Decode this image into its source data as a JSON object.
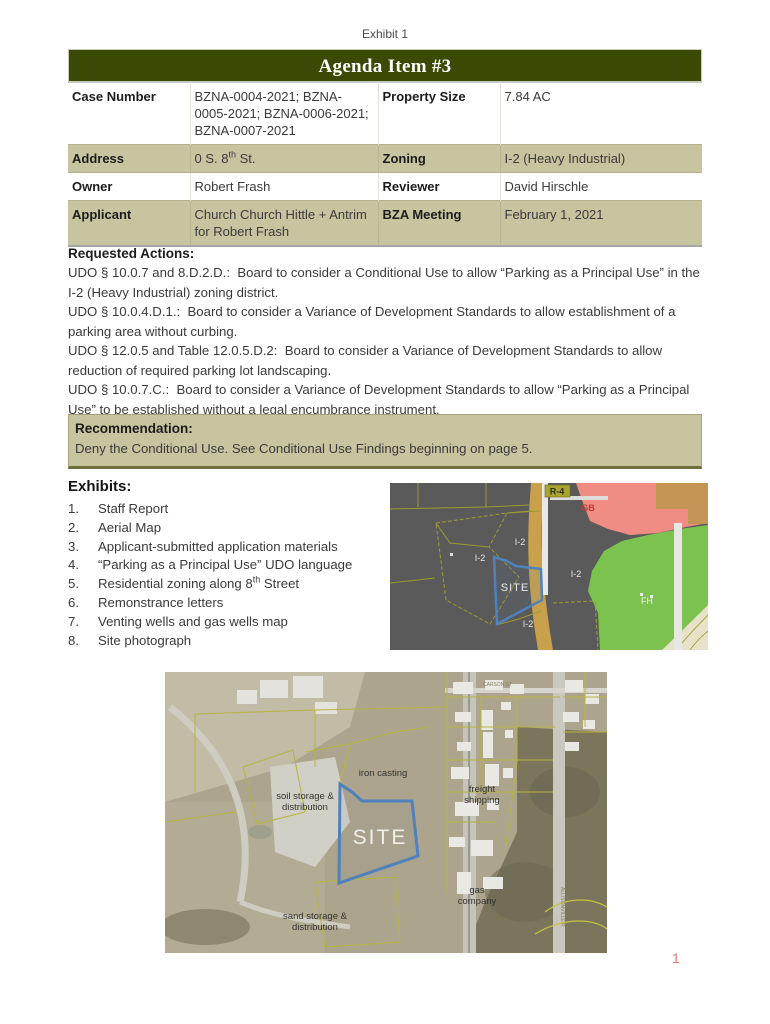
{
  "page": {
    "exhibit_label": "Exhibit 1",
    "page_number": "1"
  },
  "header": {
    "title": "Agenda Item #3"
  },
  "info_table": {
    "rows": [
      {
        "label1": "Case Number",
        "value1": "BZNA-0004-2021; BZNA-0005-2021; BZNA-0006-2021; BZNA-0007-2021",
        "label2": "Property Size",
        "value2": "7.84 AC"
      },
      {
        "label1": "Address",
        "value1_pre": "0 S. 8",
        "value1_sup": "th",
        "value1_post": " St.",
        "label2": "Zoning",
        "value2": "I-2 (Heavy Industrial)"
      },
      {
        "label1": "Owner",
        "value1": "Robert Frash",
        "label2": "Reviewer",
        "value2": "David Hirschle"
      },
      {
        "label1": "Applicant",
        "value1": "Church Church Hittle + Antrim for Robert Frash",
        "label2": "BZA Meeting",
        "value2": "February 1, 2021"
      }
    ]
  },
  "requested_actions": {
    "heading": "Requested Actions:",
    "items": [
      "UDO § 10.0.7 and 8.D.2.D.:  Board to consider a Conditional Use to allow “Parking as a Principal Use” in the I-2 (Heavy Industrial) zoning district.",
      "UDO § 10.0.4.D.1.:  Board to consider a Variance of Development Standards to allow establishment of a parking area without curbing.",
      "UDO § 12.0.5 and Table 12.0.5.D.2:  Board to consider a Variance of Development Standards to allow reduction of required parking lot landscaping.",
      "UDO § 10.0.7.C.:  Board to consider a Variance of Development Standards to allow “Parking as a Principal Use” to be established without a legal encumbrance instrument."
    ]
  },
  "recommendation": {
    "heading": "Recommendation:",
    "text": "Deny the Conditional Use. See Conditional Use Findings beginning on page 5."
  },
  "exhibits": {
    "heading": "Exhibits:",
    "items": [
      {
        "num": "1.",
        "pre": "Staff Report",
        "sup": "",
        "post": ""
      },
      {
        "num": "2.",
        "pre": "Aerial Map",
        "sup": "",
        "post": ""
      },
      {
        "num": "3.",
        "pre": "Applicant-submitted application materials",
        "sup": "",
        "post": ""
      },
      {
        "num": "4.",
        "pre": "“Parking as a Principal Use” UDO language",
        "sup": "",
        "post": ""
      },
      {
        "num": "5.",
        "pre": "Residential zoning along 8",
        "sup": "th",
        "post": " Street"
      },
      {
        "num": "6.",
        "pre": "Remonstrance letters",
        "sup": "",
        "post": ""
      },
      {
        "num": "7.",
        "pre": "Venting wells and gas wells map",
        "sup": "",
        "post": ""
      },
      {
        "num": "8.",
        "pre": "Site photograph",
        "sup": "",
        "post": ""
      }
    ]
  },
  "zoning_map": {
    "labels": {
      "site": "SITE",
      "i2": "I-2",
      "r4": "R-4",
      "gb": "GB",
      "fh": "FH"
    }
  },
  "aerial_map": {
    "labels": {
      "site": "SITE",
      "iron_casting": "iron casting",
      "soil_storage_1": "soil storage &",
      "soil_storage_2": "distribution",
      "freight_1": "freight",
      "freight_2": "shipping",
      "gas_1": "gas",
      "gas_2": "company",
      "sand_1": "sand storage &",
      "sand_2": "distribution",
      "street_1": "CARSON ST",
      "street_2": "ALLISONVILLE R"
    }
  },
  "colors": {
    "header_bg": "#3a4903",
    "row_shade": "#c7c4a0",
    "site_outline": "#4f81bd",
    "page_number": "#f4736e",
    "zone_industrial": "#5a5a5a",
    "zone_residential_pink": "#ef8c83",
    "zone_green": "#7cc24e"
  }
}
